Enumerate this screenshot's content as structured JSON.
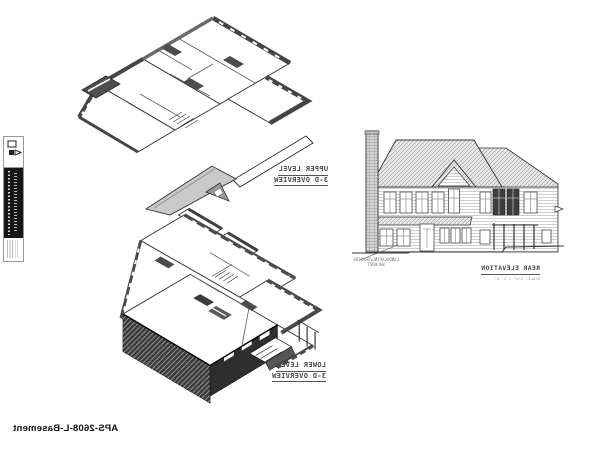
{
  "sheet": {
    "paper_color": "#ffffff",
    "ink_color": "#2e2e2e",
    "plan_number_label": "APS-2608-L-Basement",
    "text_is_mirrored": "true"
  },
  "views": {
    "upper_plan": {
      "title": "UPPER LEVEL",
      "subtitle": "3-D OVERVIEW"
    },
    "lower_plan": {
      "title": "LOWER LEVEL",
      "subtitle": "3-D OVERVIEW"
    },
    "rear_elevation": {
      "title": "REAR ELEVATION",
      "scale_note": "SCALE: 1/4\" = 1'-0\"",
      "annotation_line1": "LANDSCAPING/GRADING",
      "annotation_line2": "WALKOUT"
    }
  },
  "title_block": {
    "position": "left-edge-vertical",
    "company_bar_color": "#161616",
    "logo_icon": "publisher-logo-mark"
  }
}
